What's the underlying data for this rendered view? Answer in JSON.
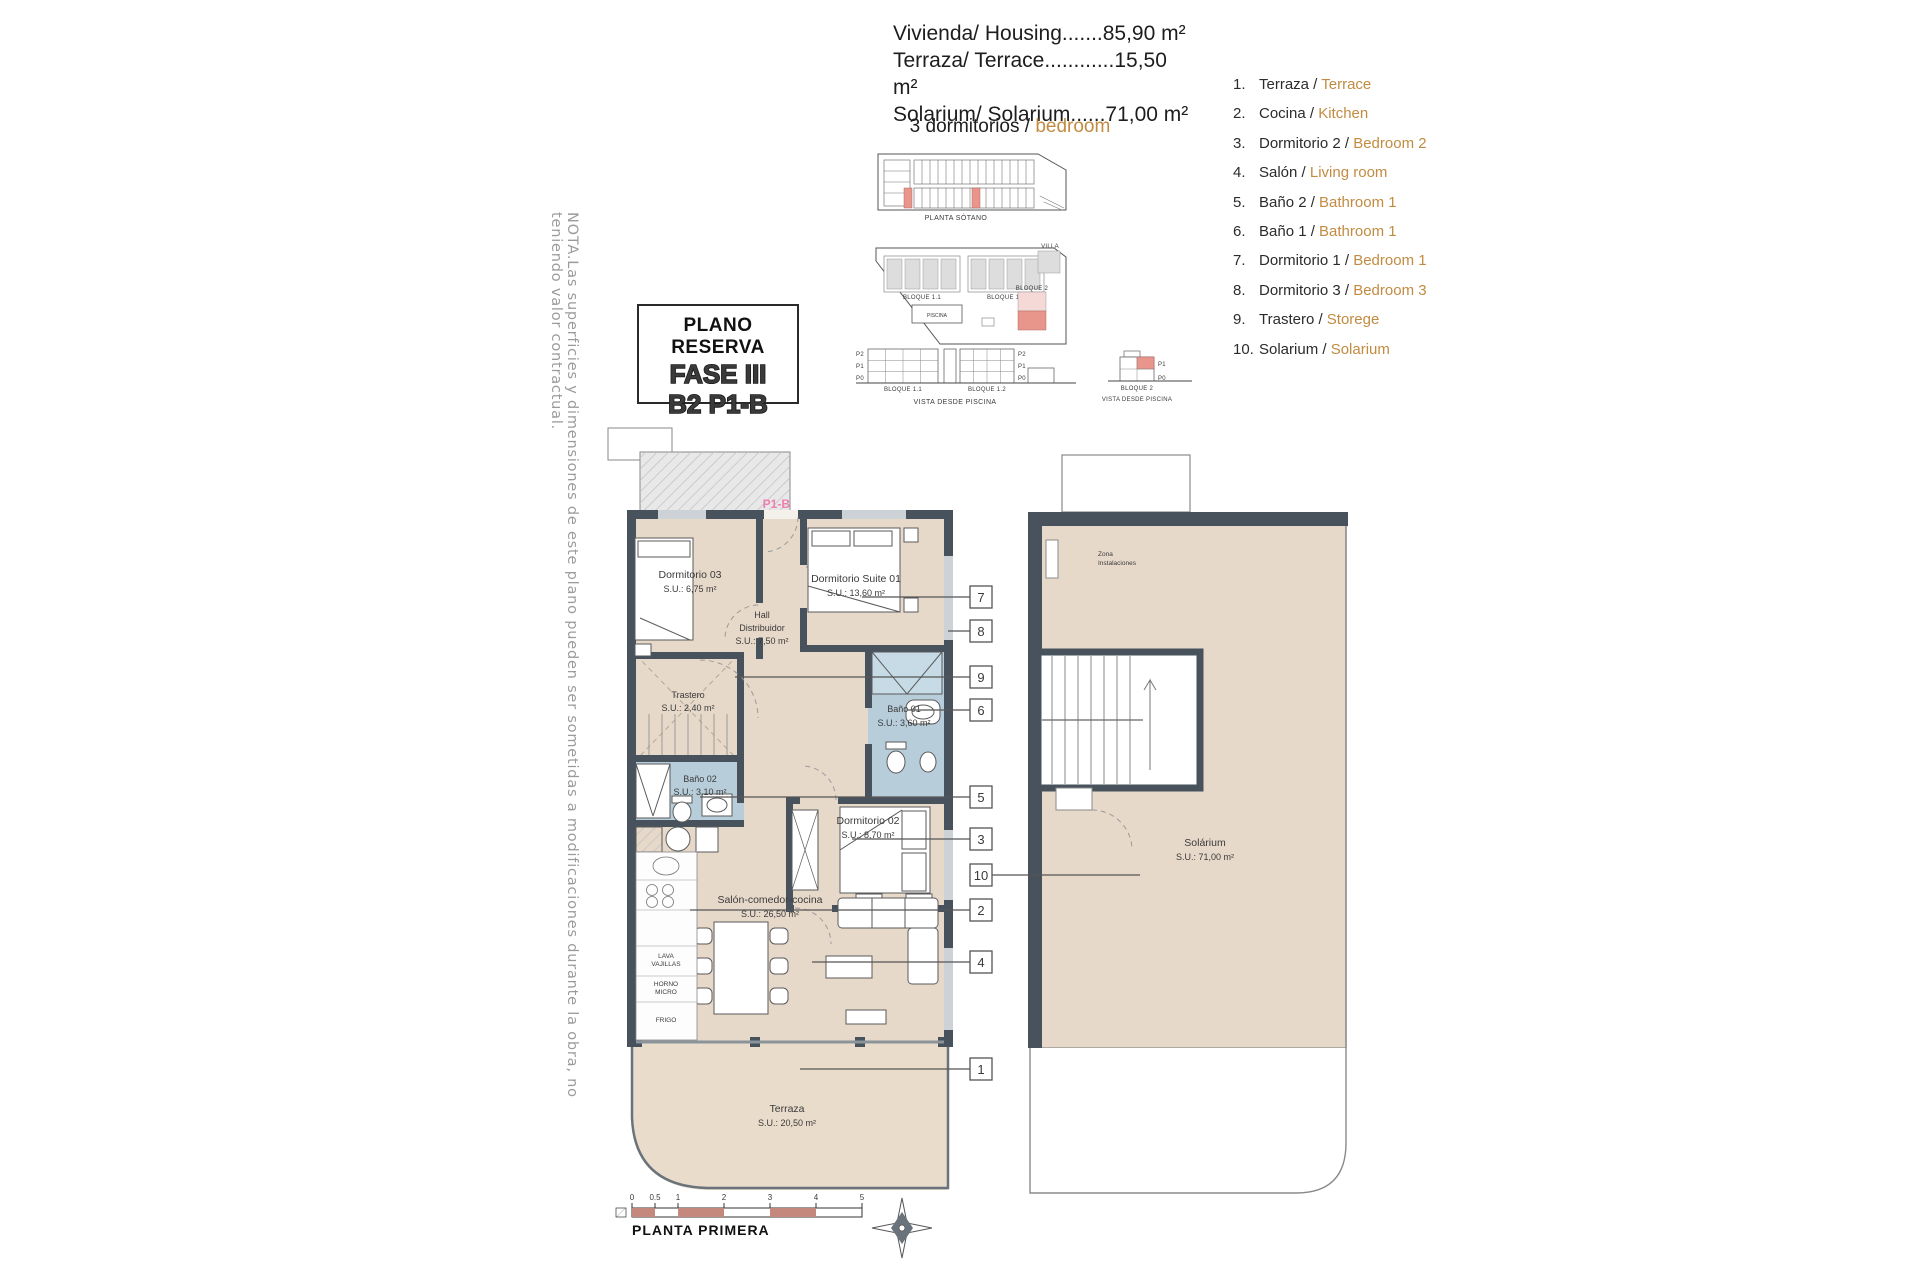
{
  "note": "NOTA.Las superficies y dimensiones de este plano pueden ser sometidas a modificaciones durante la obra, no teniendo valor contractual.",
  "summary": {
    "lines": [
      "Vivienda/ Housing.......85,90 m²",
      "Terraza/ Terrace............15,50 m²",
      "Solarium/ Solarium......71,00 m²"
    ],
    "bedrooms_es": "3 dormitorios / ",
    "bedrooms_en": "bedroom"
  },
  "legend": {
    "items": [
      {
        "num": "1.",
        "es": "Terraza / ",
        "en": "Terrace"
      },
      {
        "num": "2.",
        "es": "Cocina / ",
        "en": "Kitchen"
      },
      {
        "num": "3.",
        "es": "Dormitorio 2 / ",
        "en": "Bedroom 2"
      },
      {
        "num": "4.",
        "es": "Salón / ",
        "en": "Living room"
      },
      {
        "num": "5.",
        "es": "Baño 2 / ",
        "en": "Bathroom 1"
      },
      {
        "num": "6.",
        "es": "Baño 1 / ",
        "en": "Bathroom 1"
      },
      {
        "num": "7.",
        "es": "Dormitorio 1 / ",
        "en": "Bedroom 1"
      },
      {
        "num": "8.",
        "es": "Dormitorio 3 / ",
        "en": "Bedroom 3"
      },
      {
        "num": "9.",
        "es": "Trastero / ",
        "en": "Storege"
      },
      {
        "num": "10.",
        "es": "Solarium / ",
        "en": "Solarium"
      }
    ]
  },
  "title_block": {
    "line1": "PLANO RESERVA",
    "line2": "FASE III",
    "line3": "B2 P1-B"
  },
  "site": {
    "d1_caption": "PLANTA SÓTANO",
    "bloque11": "BLOQUE 1.1",
    "bloque12": "BLOQUE 1.2",
    "villa": "VILLA",
    "bloque2": "BLOQUE 2",
    "piscina": "PISCINA",
    "vista": "VISTA DESDE PISCINA",
    "p2": "P2",
    "p1": "P1",
    "p0": "P0"
  },
  "plan": {
    "tag": "P1-B",
    "rooms": {
      "dorm03": {
        "name": "Dormitorio 03",
        "area": "S.U.: 6,75 m²"
      },
      "suite01": {
        "name": "Dormitorio Suite 01",
        "area": "S.U.: 13,60 m²"
      },
      "hall": {
        "name": "Hall",
        "name2": "Distribuidor",
        "area": "S.U.: 7,50 m²"
      },
      "trastero": {
        "name": "Trastero",
        "area": "S.U.: 2,40 m²"
      },
      "bano01": {
        "name": "Baño 01",
        "area": "S.U.: 3,60 m²"
      },
      "bano02": {
        "name": "Baño 02",
        "area": "S.U.: 3,10 m²"
      },
      "dorm02": {
        "name": "Dormitorio 02",
        "area": "S.U.: 8,70 m²"
      },
      "salon": {
        "name": "Salón-comedor-cocina",
        "area": "S.U.: 26,50 m²"
      },
      "terraza": {
        "name": "Terraza",
        "area": "S.U.: 20,50 m²"
      }
    },
    "appliances": {
      "lava1": "LAVA",
      "lava2": "VAJILLAS",
      "horno1": "HORNO",
      "horno2": "MICRO",
      "frigo": "FRIGO"
    }
  },
  "solarium": {
    "zona1": "Zona",
    "zona2": "Instalaciones",
    "name": "Solárium",
    "area": "S.U.: 71,00 m²"
  },
  "callouts": {
    "c1": "1",
    "c2": "2",
    "c3": "3",
    "c4": "4",
    "c5": "5",
    "c6": "6",
    "c7": "7",
    "c8": "8",
    "c9": "9",
    "c10": "10"
  },
  "footer": {
    "plan_name": "PLANTA PRIMERA",
    "scale_ticks": [
      "0",
      "0.5",
      "1",
      "2",
      "3",
      "4",
      "5"
    ]
  },
  "colors": {
    "accent_orange": "#c28b41",
    "wall": "#47525c",
    "floor": "#e7d9ca",
    "bath_blue": "#b7cdda",
    "pink_tag": "#ee7fae",
    "unit_red": "#e8958c",
    "scale_red": "#c4897c",
    "hatch_grey": "#e8e8e8"
  }
}
